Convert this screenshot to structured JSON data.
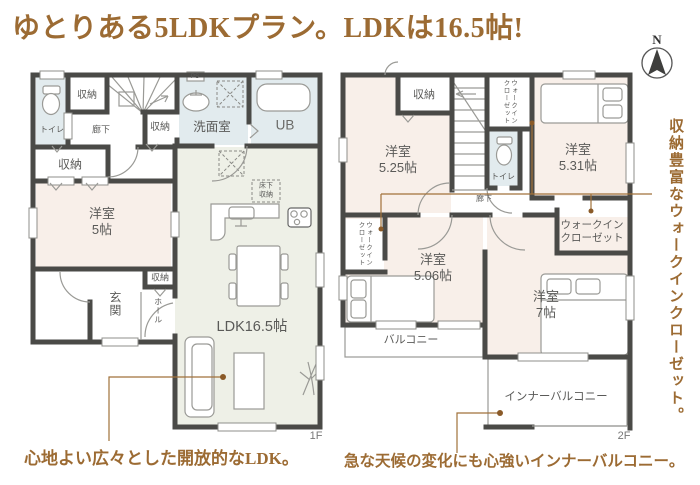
{
  "title": "ゆとりある5LDKプラン。LDKは16.5帖!",
  "compass_n": "N",
  "side_caption": "収納豊富なウォークインクローゼット。",
  "floor1": {
    "caption": "心地よい広々とした開放的なLDK。",
    "floor_label": "1F",
    "labels": {
      "toilet": "トイレ",
      "storage_a": "収納",
      "corridor": "廊下",
      "storage_b": "収納",
      "ps": "PS",
      "washroom": "洗面室",
      "unit_bath": "UB",
      "storage_c": "収納",
      "bedroom5": "洋室\n5帖",
      "entrance": "玄関",
      "storage_d": "収納",
      "hall": "ホール",
      "underfloor_storage": "床下\n収納",
      "ldk": "LDK16.5帖"
    }
  },
  "floor2": {
    "caption": "急な天候の変化にも心強いインナーバルコニー。",
    "floor_label": "2F",
    "labels": {
      "storage": "収納",
      "bedroom_525": "洋室\n5.25帖",
      "wic_top": "ウォークイン\nクローゼット",
      "toilet": "トイレ",
      "bedroom_531": "洋室\n5.31帖",
      "corridor": "廊下",
      "wic_right": "ウォークイン\nクローゼット",
      "wic_left": "ウォークイン\nクローゼット",
      "bedroom_506": "洋室\n5.06帖",
      "bedroom_7": "洋室\n7帖",
      "balcony": "バルコニー",
      "inner_balcony": "インナーバルコニー"
    }
  },
  "colors": {
    "accent_brown": "#9c6b33",
    "leader_brown": "#a1713a",
    "wall": "#4a4a47",
    "room_pink": "#f8efe9",
    "room_green": "#eef0e7",
    "room_blue": "#e2ebee"
  }
}
